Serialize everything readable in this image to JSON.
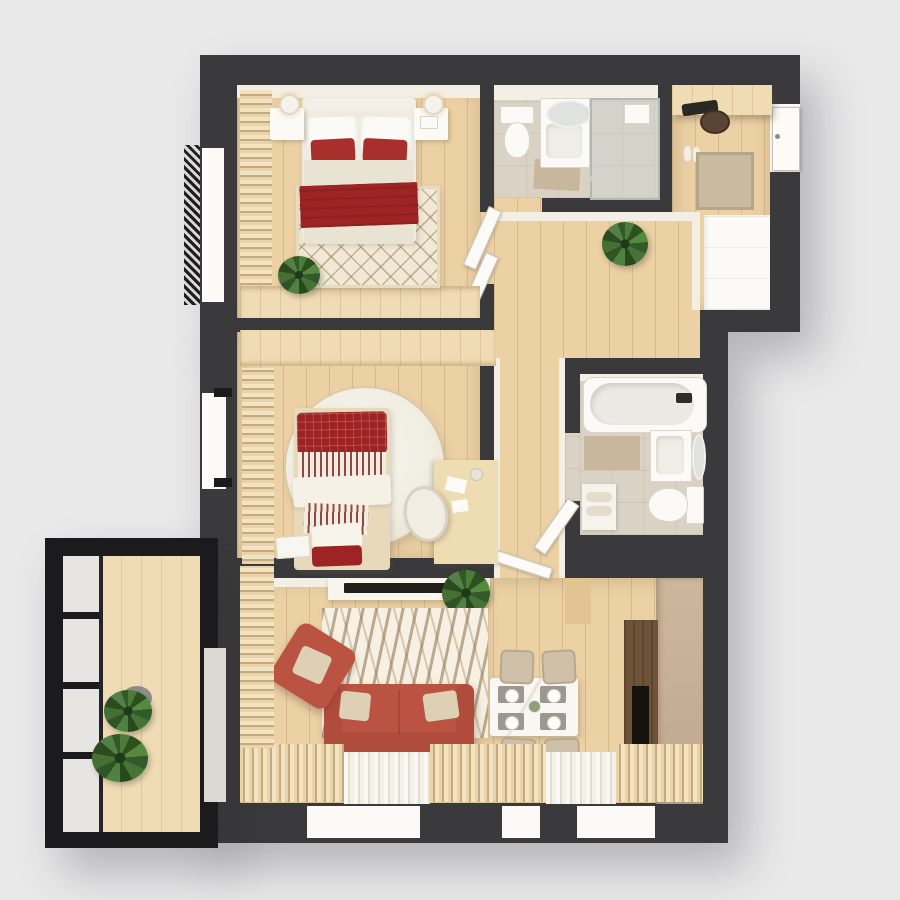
{
  "scene": {
    "type": "3d-floor-plan-top-down-render",
    "description": "Top-down 3D render of a two-bedroom apartment: master bedroom with red bedding, two bathrooms, entry hall with wardrobe shelf, central hallway, second bedroom with desk and round shag rug, living room with terracotta sofa, zebra rug, TV console and dining set, and a black-framed glazed balcony with plants",
    "style": "dark charcoal walls, light oak plank flooring, white fixtures, red and beige textile accents"
  },
  "colors": {
    "bg": "#e9e9ea",
    "wall": "#3a393b",
    "wall-dark": "#1b1b1d",
    "wood": "#ecd1a5",
    "wood-light": "#f0dcb4",
    "tile": "#d9d2c5",
    "white": "#fbfaf7",
    "cream": "#f4efe5",
    "rug": "#f1e9d6",
    "red": "#9e2424",
    "red-bright": "#a82f2c",
    "terracotta": "#bb5342",
    "beige": "#ddd0b4",
    "mat": "#c8b79c",
    "green": "#3c6a30",
    "tan": "#c3ac92",
    "dark-wood": "#6e5338",
    "marble": "#f9f7f3"
  },
  "rooms": [
    {
      "name": "bedroom-1",
      "furniture": [
        "double-bed",
        "white-pillows",
        "red-accent-pillows",
        "red-throw-blanket",
        "nightstand-left",
        "nightstand-right",
        "table-lamps",
        "diamond-pattern-rug",
        "built-in-wardrobe",
        "curtains",
        "potted-plant",
        "window-with-railing"
      ]
    },
    {
      "name": "bathroom-1",
      "furniture": [
        "toilet",
        "vanity-sink",
        "round-mirror",
        "walk-in-shower",
        "bath-mat"
      ]
    },
    {
      "name": "entry-hall",
      "furniture": [
        "entrance-door",
        "wardrobe-shelf",
        "clothes",
        "doormat",
        "shoes",
        "storage-cabinet"
      ]
    },
    {
      "name": "hallway",
      "furniture": [
        "potted-plant",
        "interior-door-leaves"
      ]
    },
    {
      "name": "bedroom-2",
      "furniture": [
        "single-bed",
        "plaid-pillow",
        "striped-bedding",
        "round-shaggy-rug",
        "desk",
        "desk-chair",
        "papers",
        "curtains",
        "built-in-wardrobe",
        "window",
        "book-on-floor"
      ]
    },
    {
      "name": "bathroom-2",
      "furniture": [
        "bathtub",
        "vanity-sink",
        "oval-mirror",
        "toilet",
        "towel-shelf",
        "bath-mat"
      ]
    },
    {
      "name": "living-room",
      "furniture": [
        "terracotta-sofa",
        "beige-sofa-cushions",
        "terracotta-armchair",
        "zebra-pattern-rug",
        "tv",
        "tv-console",
        "dining-table",
        "dining-chairs",
        "place-settings",
        "tall-tan-cabinet",
        "dark-wood-media-cabinet",
        "potted-plant",
        "curtains",
        "windows"
      ]
    },
    {
      "name": "balcony",
      "furniture": [
        "black-glazed-frame",
        "wood-decking",
        "potted-plants"
      ]
    }
  ]
}
